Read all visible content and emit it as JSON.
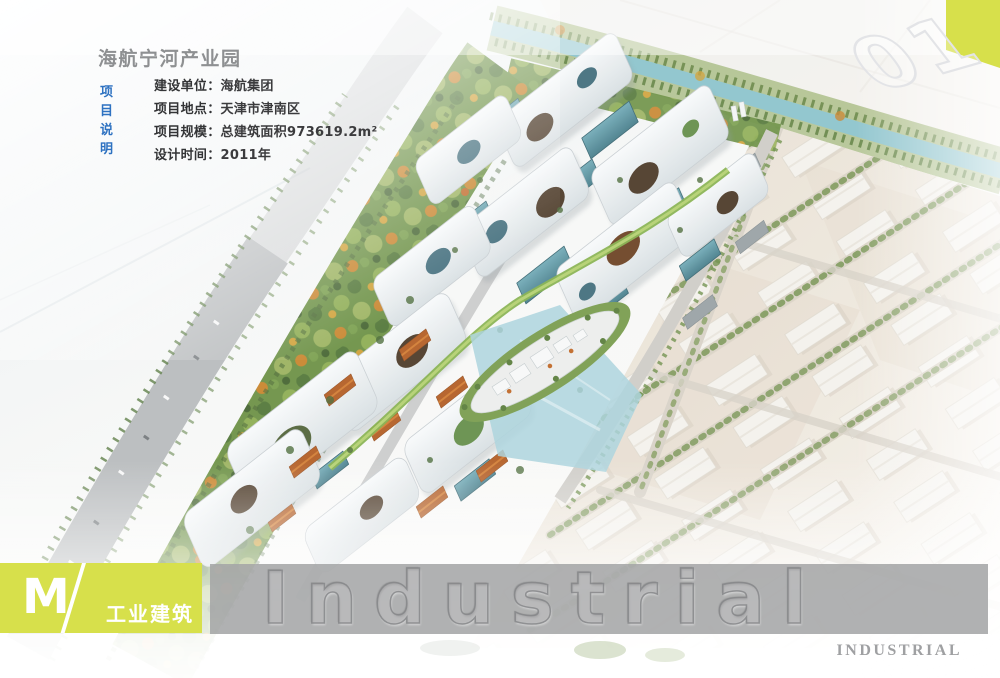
{
  "header": {
    "title": "海航宁河产业园",
    "section_label": "项目说明",
    "details": [
      {
        "label": "建设单位：",
        "value": "海航集团"
      },
      {
        "label": "项目地点：",
        "value": "天津市津南区"
      },
      {
        "label": "项目规模：",
        "value": "总建筑面积973619.2m²"
      },
      {
        "label": "设计时间：",
        "value": "2011年"
      }
    ]
  },
  "corner": {
    "number": "01"
  },
  "footer": {
    "letter": "M",
    "category": "工业建筑",
    "watermark": "Industrial",
    "caption": "INDUSTRIAL"
  },
  "colors": {
    "accent_lime": "#d7e04b",
    "label_blue": "#2e72c1",
    "title_gray": "#8e9092",
    "bar_gray": "#a5a6a8",
    "river_teal": "#8ec4cd",
    "roof_white": "#f2f5f6",
    "glass_teal": "#5d98a6",
    "ground_beige": "#e9e2d6",
    "park_green": "#6e9247",
    "roof_orange": "#b45f26"
  }
}
